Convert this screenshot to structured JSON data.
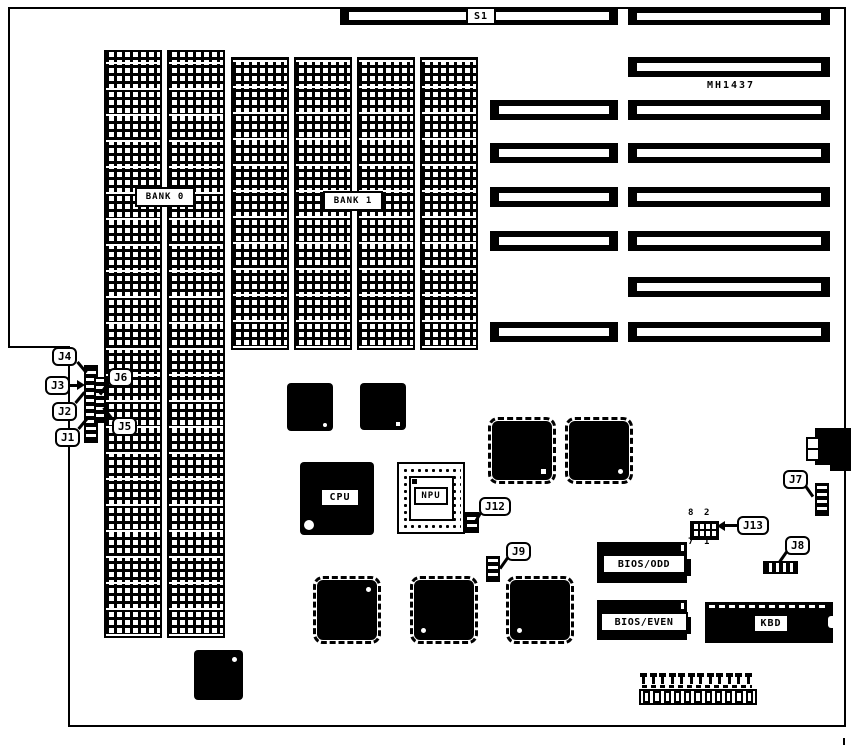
{
  "diagram": {
    "type": "motherboard-layout",
    "part_number": "MH1437",
    "ink_color": "#000000",
    "background_color": "#ffffff"
  },
  "labels": {
    "s1": "S1",
    "part": "MH1437",
    "bank0": "BANK 0",
    "bank1": "BANK 1",
    "cpu": "CPU",
    "npu": "NPU",
    "bios_odd": "BIOS/ODD",
    "bios_even": "BIOS/EVEN",
    "kbd": "KBD"
  },
  "jumpers": {
    "j1": "J1",
    "j2": "J2",
    "j3": "J3",
    "j4": "J4",
    "j5": "J5",
    "j6": "J6",
    "j7": "J7",
    "j8": "J8",
    "j9": "J9",
    "j12": "J12",
    "j13": "J13"
  },
  "j13_pins": {
    "top_left": "8",
    "top_right": "2",
    "bottom_left": "7",
    "bottom_right": "1"
  }
}
